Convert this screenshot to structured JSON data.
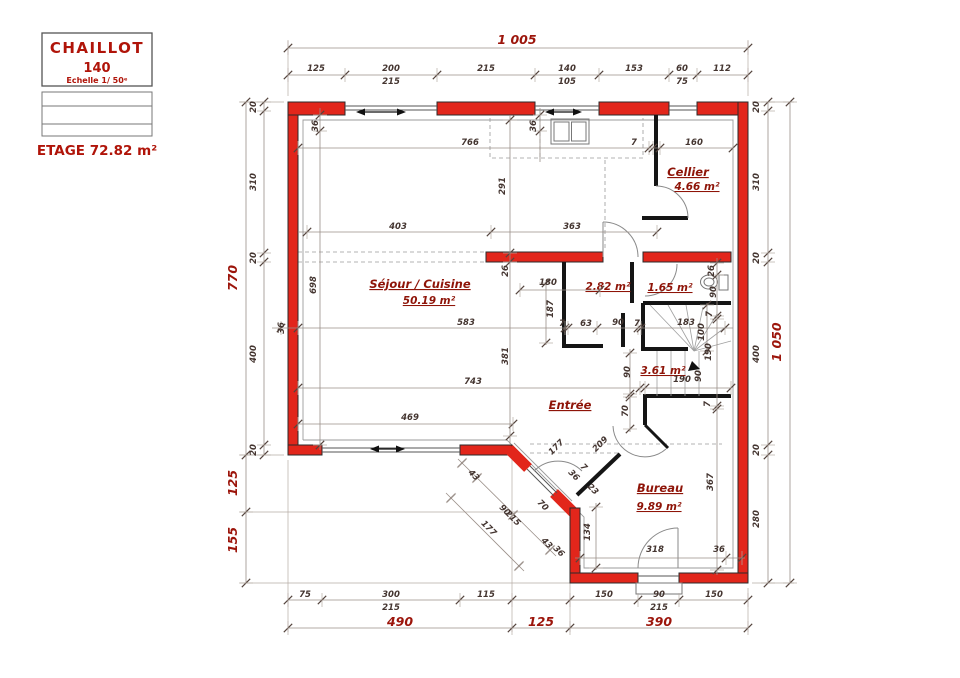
{
  "title_block": {
    "name": "CHAILLOT",
    "model": "140",
    "scale": "Echelle 1/ 50ᵉ",
    "floor_label": "ETAGE 72.82 m²"
  },
  "rooms": [
    {
      "label": "Cellier",
      "area": "4.66 m²"
    },
    {
      "label": "Séjour / Cuisine",
      "area": "50.19 m²"
    },
    {
      "label": "2.82 m²"
    },
    {
      "label": "1.65 m²"
    },
    {
      "label": "3.61 m²"
    },
    {
      "label": "Entrée"
    },
    {
      "label": "Bureau",
      "area": "9.89 m²"
    }
  ],
  "plan": {
    "wall_color": "#e2261b",
    "accent_text_color": "#9c150b",
    "labels": [
      {
        "t": "1 005",
        "x": 517,
        "y": 44,
        "c": "big"
      },
      {
        "t": "125",
        "x": 316,
        "y": 71
      },
      {
        "t": "200",
        "x": 391,
        "y": 71
      },
      {
        "t": "215",
        "x": 391,
        "y": 84
      },
      {
        "t": "215",
        "x": 486,
        "y": 71
      },
      {
        "t": "140",
        "x": 567,
        "y": 71
      },
      {
        "t": "105",
        "x": 567,
        "y": 84
      },
      {
        "t": "153",
        "x": 634,
        "y": 71
      },
      {
        "t": "60",
        "x": 682,
        "y": 71
      },
      {
        "t": "75",
        "x": 682,
        "y": 84
      },
      {
        "t": "112",
        "x": 722,
        "y": 71
      },
      {
        "t": "20",
        "x": 256,
        "y": 107,
        "r": -90
      },
      {
        "t": "310",
        "x": 256,
        "y": 182,
        "r": -90
      },
      {
        "t": "20",
        "x": 256,
        "y": 258,
        "r": -90
      },
      {
        "t": "400",
        "x": 256,
        "y": 354,
        "r": -90
      },
      {
        "t": "20",
        "x": 256,
        "y": 450,
        "r": -90
      },
      {
        "t": "770",
        "x": 237,
        "y": 278,
        "r": -90,
        "c": "big"
      },
      {
        "t": "125",
        "x": 237,
        "y": 483,
        "r": -90,
        "c": "big"
      },
      {
        "t": "155",
        "x": 237,
        "y": 540,
        "r": -90,
        "c": "big"
      },
      {
        "t": "20",
        "x": 759,
        "y": 107,
        "r": -90
      },
      {
        "t": "310",
        "x": 759,
        "y": 182,
        "r": -90
      },
      {
        "t": "20",
        "x": 759,
        "y": 258,
        "r": -90
      },
      {
        "t": "400",
        "x": 759,
        "y": 354,
        "r": -90
      },
      {
        "t": "20",
        "x": 759,
        "y": 450,
        "r": -90
      },
      {
        "t": "280",
        "x": 759,
        "y": 519,
        "r": -90
      },
      {
        "t": "1 050",
        "x": 781,
        "y": 342,
        "r": -90,
        "c": "big"
      },
      {
        "t": "75",
        "x": 305,
        "y": 597
      },
      {
        "t": "300",
        "x": 391,
        "y": 597
      },
      {
        "t": "215",
        "x": 391,
        "y": 610
      },
      {
        "t": "115",
        "x": 486,
        "y": 597
      },
      {
        "t": "150",
        "x": 604,
        "y": 597
      },
      {
        "t": "90",
        "x": 659,
        "y": 597
      },
      {
        "t": "215",
        "x": 659,
        "y": 610
      },
      {
        "t": "150",
        "x": 714,
        "y": 597
      },
      {
        "t": "490",
        "x": 400,
        "y": 626,
        "c": "big"
      },
      {
        "t": "125",
        "x": 541,
        "y": 626,
        "c": "big"
      },
      {
        "t": "390",
        "x": 659,
        "y": 626,
        "c": "big"
      },
      {
        "t": "36",
        "x": 318,
        "y": 126,
        "r": -90
      },
      {
        "t": "766",
        "x": 470,
        "y": 145
      },
      {
        "t": "36",
        "x": 536,
        "y": 126,
        "r": -90
      },
      {
        "t": "7",
        "x": 634,
        "y": 145
      },
      {
        "t": "160",
        "x": 694,
        "y": 145
      },
      {
        "t": "291",
        "x": 505,
        "y": 186,
        "r": -90
      },
      {
        "t": "403",
        "x": 398,
        "y": 229
      },
      {
        "t": "363",
        "x": 572,
        "y": 229
      },
      {
        "t": "698",
        "x": 316,
        "y": 285,
        "r": -90
      },
      {
        "t": "26",
        "x": 508,
        "y": 271,
        "r": -90
      },
      {
        "t": "180",
        "x": 548,
        "y": 285
      },
      {
        "t": "187",
        "x": 553,
        "y": 309,
        "r": -90
      },
      {
        "t": "583",
        "x": 466,
        "y": 325
      },
      {
        "t": "36",
        "x": 284,
        "y": 328,
        "r": -90
      },
      {
        "t": "7",
        "x": 562,
        "y": 326
      },
      {
        "t": "63",
        "x": 586,
        "y": 326
      },
      {
        "t": "90",
        "x": 618,
        "y": 325
      },
      {
        "t": "7",
        "x": 637,
        "y": 326
      },
      {
        "t": "183",
        "x": 686,
        "y": 325
      },
      {
        "t": "100",
        "x": 704,
        "y": 332,
        "r": -90
      },
      {
        "t": "7",
        "x": 712,
        "y": 314,
        "r": -90
      },
      {
        "t": "26",
        "x": 714,
        "y": 271,
        "r": -90
      },
      {
        "t": "90",
        "x": 716,
        "y": 292,
        "r": -90
      },
      {
        "t": "381",
        "x": 508,
        "y": 356,
        "r": -90
      },
      {
        "t": "190",
        "x": 711,
        "y": 352,
        "r": -90
      },
      {
        "t": "90",
        "x": 630,
        "y": 372,
        "r": -90
      },
      {
        "t": "90",
        "x": 701,
        "y": 376,
        "r": -90
      },
      {
        "t": "190",
        "x": 682,
        "y": 382
      },
      {
        "t": "7",
        "x": 710,
        "y": 404,
        "r": -90
      },
      {
        "t": "70",
        "x": 628,
        "y": 411,
        "r": -90
      },
      {
        "t": "743",
        "x": 473,
        "y": 384
      },
      {
        "t": "469",
        "x": 410,
        "y": 420
      },
      {
        "t": "177",
        "x": 558,
        "y": 449,
        "r": -45
      },
      {
        "t": "209",
        "x": 602,
        "y": 446,
        "r": -45
      },
      {
        "t": "43",
        "x": 472,
        "y": 477,
        "r": 45
      },
      {
        "t": "90",
        "x": 503,
        "y": 512,
        "r": 45
      },
      {
        "t": "215",
        "x": 511,
        "y": 520,
        "r": 45
      },
      {
        "t": "43",
        "x": 545,
        "y": 545,
        "r": 45
      },
      {
        "t": "36",
        "x": 557,
        "y": 553,
        "r": 45
      },
      {
        "t": "177",
        "x": 487,
        "y": 530,
        "r": 45
      },
      {
        "t": "70",
        "x": 541,
        "y": 507,
        "r": 45
      },
      {
        "t": "36",
        "x": 572,
        "y": 477,
        "r": 45
      },
      {
        "t": "7",
        "x": 582,
        "y": 469,
        "r": 45
      },
      {
        "t": "23",
        "x": 591,
        "y": 491,
        "r": 45
      },
      {
        "t": "134",
        "x": 590,
        "y": 532,
        "r": -90
      },
      {
        "t": "367",
        "x": 713,
        "y": 482,
        "r": -90
      },
      {
        "t": "318",
        "x": 655,
        "y": 552
      },
      {
        "t": "36",
        "x": 719,
        "y": 552
      }
    ],
    "chains": [
      {
        "l": [
          288,
          48,
          748,
          48
        ],
        "t": [
          [
            288,
            48
          ],
          [
            748,
            48
          ]
        ]
      },
      {
        "l": [
          288,
          75,
          748,
          75
        ],
        "t": [
          [
            288,
            75
          ],
          [
            345,
            75
          ],
          [
            437,
            75
          ],
          [
            535,
            75
          ],
          [
            599,
            75
          ],
          [
            669,
            75
          ],
          [
            697,
            75
          ],
          [
            748,
            75
          ]
        ]
      },
      {
        "l": [
          264,
          102,
          264,
          455
        ],
        "t": [
          [
            264,
            102
          ],
          [
            264,
            111
          ],
          [
            264,
            253
          ],
          [
            264,
            262
          ],
          [
            264,
            445
          ],
          [
            264,
            455
          ]
        ]
      },
      {
        "l": [
          246,
          102,
          246,
          583
        ],
        "t": [
          [
            246,
            102
          ],
          [
            246,
            455
          ],
          [
            246,
            512
          ],
          [
            246,
            583
          ]
        ]
      },
      {
        "l": [
          768,
          102,
          768,
          583
        ],
        "t": [
          [
            768,
            102
          ],
          [
            768,
            111
          ],
          [
            768,
            253
          ],
          [
            768,
            262
          ],
          [
            768,
            445
          ],
          [
            768,
            455
          ],
          [
            768,
            583
          ]
        ]
      },
      {
        "l": [
          790,
          102,
          790,
          583
        ],
        "t": [
          [
            790,
            102
          ],
          [
            790,
            583
          ]
        ]
      },
      {
        "l": [
          288,
          600,
          748,
          600
        ],
        "t": [
          [
            288,
            600
          ],
          [
            322,
            600
          ],
          [
            460,
            600
          ],
          [
            512,
            600
          ],
          [
            570,
            600
          ],
          [
            638,
            600
          ],
          [
            679,
            600
          ],
          [
            748,
            600
          ]
        ]
      },
      {
        "l": [
          288,
          628,
          748,
          628
        ],
        "t": [
          [
            288,
            628
          ],
          [
            512,
            628
          ],
          [
            570,
            628
          ],
          [
            748,
            628
          ]
        ]
      },
      {
        "l": [
          298,
          148,
          733,
          148
        ],
        "t": [
          [
            298,
            148
          ],
          [
            649,
            148
          ],
          [
            653,
            148
          ],
          [
            660,
            148
          ],
          [
            733,
            148
          ]
        ]
      },
      {
        "l": [
          298,
          232,
          657,
          232
        ],
        "t": [
          [
            307,
            232
          ],
          [
            491,
            232
          ],
          [
            657,
            232
          ]
        ]
      },
      {
        "l": [
          272,
          328,
          733,
          328
        ],
        "t": [
          [
            281,
            328
          ],
          [
            298,
            328
          ],
          [
            565,
            328
          ],
          [
            568,
            328
          ],
          [
            597,
            328
          ],
          [
            638,
            328
          ],
          [
            641,
            328
          ],
          [
            725,
            328
          ]
        ]
      },
      {
        "l": [
          298,
          388,
          731,
          388
        ],
        "t": [
          [
            298,
            388
          ],
          [
            640,
            388
          ],
          [
            645,
            388
          ],
          [
            731,
            388
          ]
        ]
      },
      {
        "l": [
          298,
          424,
          513,
          424
        ],
        "t": [
          [
            298,
            424
          ],
          [
            513,
            424
          ]
        ]
      },
      {
        "l": [
          320,
          108,
          320,
          450
        ],
        "t": [
          [
            320,
            115
          ],
          [
            320,
            131
          ],
          [
            320,
            445
          ]
        ]
      },
      {
        "l": [
          510,
          115,
          510,
          445
        ],
        "t": [
          [
            510,
            120
          ],
          [
            510,
            253
          ],
          [
            510,
            262
          ],
          [
            510,
            436
          ]
        ]
      },
      {
        "l": [
          540,
          108,
          540,
          162
        ],
        "t": [
          [
            540,
            115
          ],
          [
            540,
            131
          ]
        ]
      },
      {
        "l": [
          546,
          280,
          546,
          345
        ],
        "t": [
          [
            546,
            283
          ],
          [
            546,
            343
          ]
        ]
      },
      {
        "l": [
          520,
          290,
          600,
          290
        ],
        "t": [
          [
            520,
            290
          ],
          [
            600,
            290
          ]
        ]
      },
      {
        "l": [
          717,
          258,
          717,
          575
        ],
        "t": [
          [
            717,
            263
          ],
          [
            717,
            275
          ],
          [
            717,
            316
          ],
          [
            717,
            319
          ],
          [
            717,
            406
          ],
          [
            717,
            409
          ],
          [
            717,
            570
          ]
        ]
      },
      {
        "l": [
          630,
          349,
          630,
          432
        ],
        "t": [
          [
            630,
            353
          ],
          [
            630,
            394
          ],
          [
            630,
            397
          ],
          [
            630,
            429
          ]
        ]
      },
      {
        "l": [
          707,
          303,
          707,
          353
        ],
        "t": [
          [
            707,
            305
          ],
          [
            707,
            351
          ]
        ]
      },
      {
        "l": [
          575,
          558,
          745,
          558
        ],
        "t": [
          [
            580,
            558
          ],
          [
            726,
            558
          ],
          [
            742,
            558
          ]
        ]
      },
      {
        "l": [
          596,
          503,
          596,
          570
        ],
        "t": [
          [
            596,
            507
          ],
          [
            596,
            568
          ]
        ]
      },
      {
        "l": [
          458,
          459,
          556,
          556
        ],
        "t": [
          [
            462,
            463
          ],
          [
            477,
            478
          ],
          [
            513,
            515
          ],
          [
            550,
            550
          ]
        ]
      },
      {
        "l": [
          446,
          493,
          524,
          571
        ],
        "t": [
          [
            451,
            498
          ],
          [
            519,
            566
          ]
        ]
      }
    ]
  }
}
